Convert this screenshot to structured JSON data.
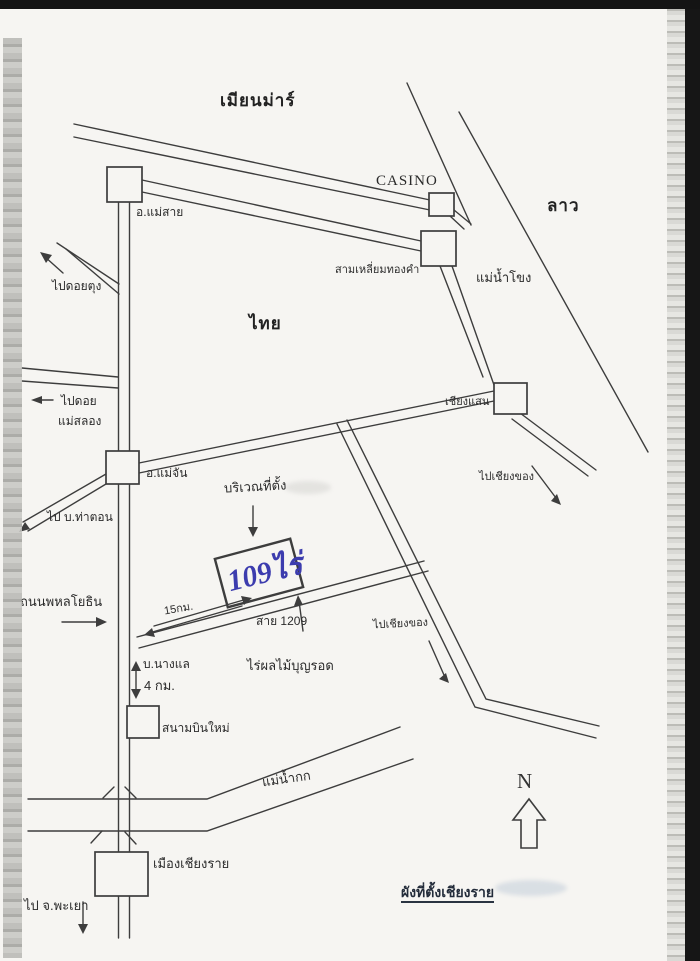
{
  "colors": {
    "ink": "#3d3d3d",
    "handwriting_blue": "#3c3cae",
    "paper": "#f6f5f2"
  },
  "map": {
    "title": "ผังที่ตั้งเชียงราย",
    "compass_north": "N",
    "countries": {
      "myanmar": "เมียนม่าร์",
      "laos": "ลาว",
      "thailand": "ไทย"
    },
    "places": {
      "casino": "CASINO",
      "mae_sai": "อ.แม่สาย",
      "golden_triangle": "สามเหลี่ยมทองคำ",
      "chiang_saen": "เชียงแสน",
      "mae_chan": "อ.แม่จัน",
      "ban_nang_lae": "บ.นางแล",
      "boonrod_farm": "ไร่ผลไม้บุญรอด",
      "new_airport": "สนามบินใหม่",
      "chiang_rai_city": "เมืองเชียงราย",
      "phahonyothin_road": "ถนนพหลโยธิน"
    },
    "rivers": {
      "mekong": "แม่น้ำโขง",
      "kok": "แม่น้ำกก"
    },
    "directions": {
      "to_doi_tung": "ไปดอยตุง",
      "to_mae_salong_line1": "ไปดอย",
      "to_mae_salong_line2": "แม่สลอง",
      "to_tha_ton": "ไป บ.ท่าตอน",
      "to_chiang_khong_upper": "ไปเชียงของ",
      "to_chiang_khong_lower": "ไปเชียงของ",
      "to_phayao": "ไป จ.พะเยา"
    },
    "site": {
      "area_label": "บริเวณที่ตั้ง",
      "plot_size": "109ไร่"
    },
    "routes": {
      "route_1209": "สาย 1209",
      "distance_15km": "15กม.",
      "distance_4km": "4 กม."
    }
  }
}
